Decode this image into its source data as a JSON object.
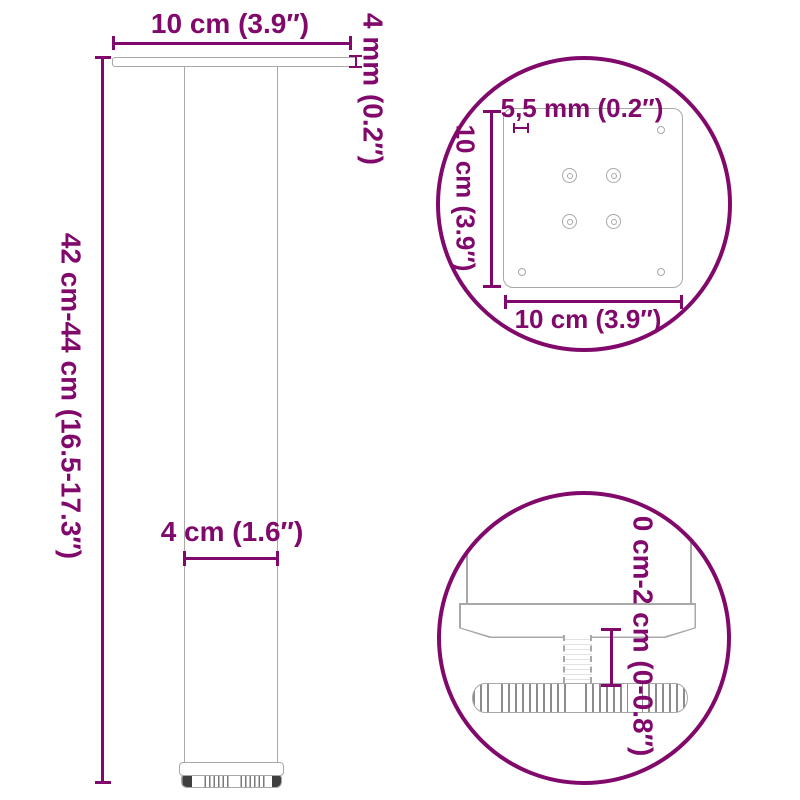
{
  "diagram_title": "table-leg-dimension-diagram",
  "colors": {
    "dimension_magenta": "#80096B",
    "drawing_gray": "#A8A8A8",
    "knurl_stripe_gray": "#7A7A7A",
    "knurl_dark": "#3F3F3F",
    "background": "#FFFFFF"
  },
  "main_view": {
    "plate_width_label": "10 cm (3.9″)",
    "plate_thickness_label": "4 mm (0.2″)",
    "leg_height_label": "42 cm-44 cm (16.5-17.3″)",
    "tube_diameter_label": "4 cm (1.6″)"
  },
  "plate_detail_view": {
    "hole_diameter_label": "5,5 mm (0.2″)",
    "plate_depth_label": "10 cm (3.9″)",
    "plate_width_label": "10 cm (3.9″)"
  },
  "foot_detail_view": {
    "height_adjustment_label": "0 cm-2 cm (0-0.8″)"
  }
}
